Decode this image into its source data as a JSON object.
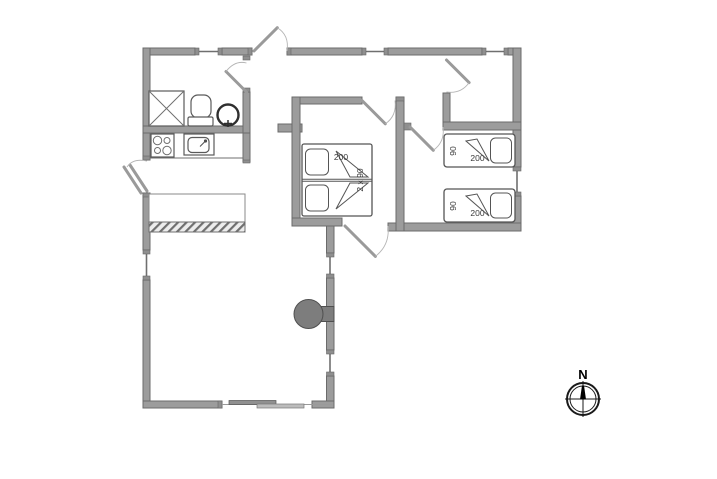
{
  "plan": {
    "type": "holiday-house-floor-plan",
    "compass": {
      "north_label": "N"
    },
    "beds": {
      "double": {
        "length_label": "200",
        "width_label": "2 x 90"
      },
      "single1": {
        "width_label": "90",
        "length_label": "200"
      },
      "single2": {
        "width_label": "90",
        "length_label": "200"
      }
    },
    "rooms": {
      "bathroom_fixtures": [
        "shower",
        "toilet",
        "washbasin"
      ],
      "kitchen_fixtures": [
        "stove",
        "kitchen-sink"
      ],
      "living_fixtures": [
        "wood-stove",
        "sliding-door"
      ]
    },
    "icons": [
      "shower-icon",
      "toilet-icon",
      "washbasin-icon",
      "stove-icon",
      "kitchen-sink-icon",
      "fireplace-icon",
      "north-compass-icon"
    ],
    "colors": {
      "wall": "#9c9c9c",
      "wall_border": "#6b6b6b",
      "fixture_line": "#4f4f4f",
      "fireplace": "#7d7d7d",
      "compass": "#111111",
      "background": "#ffffff"
    }
  }
}
